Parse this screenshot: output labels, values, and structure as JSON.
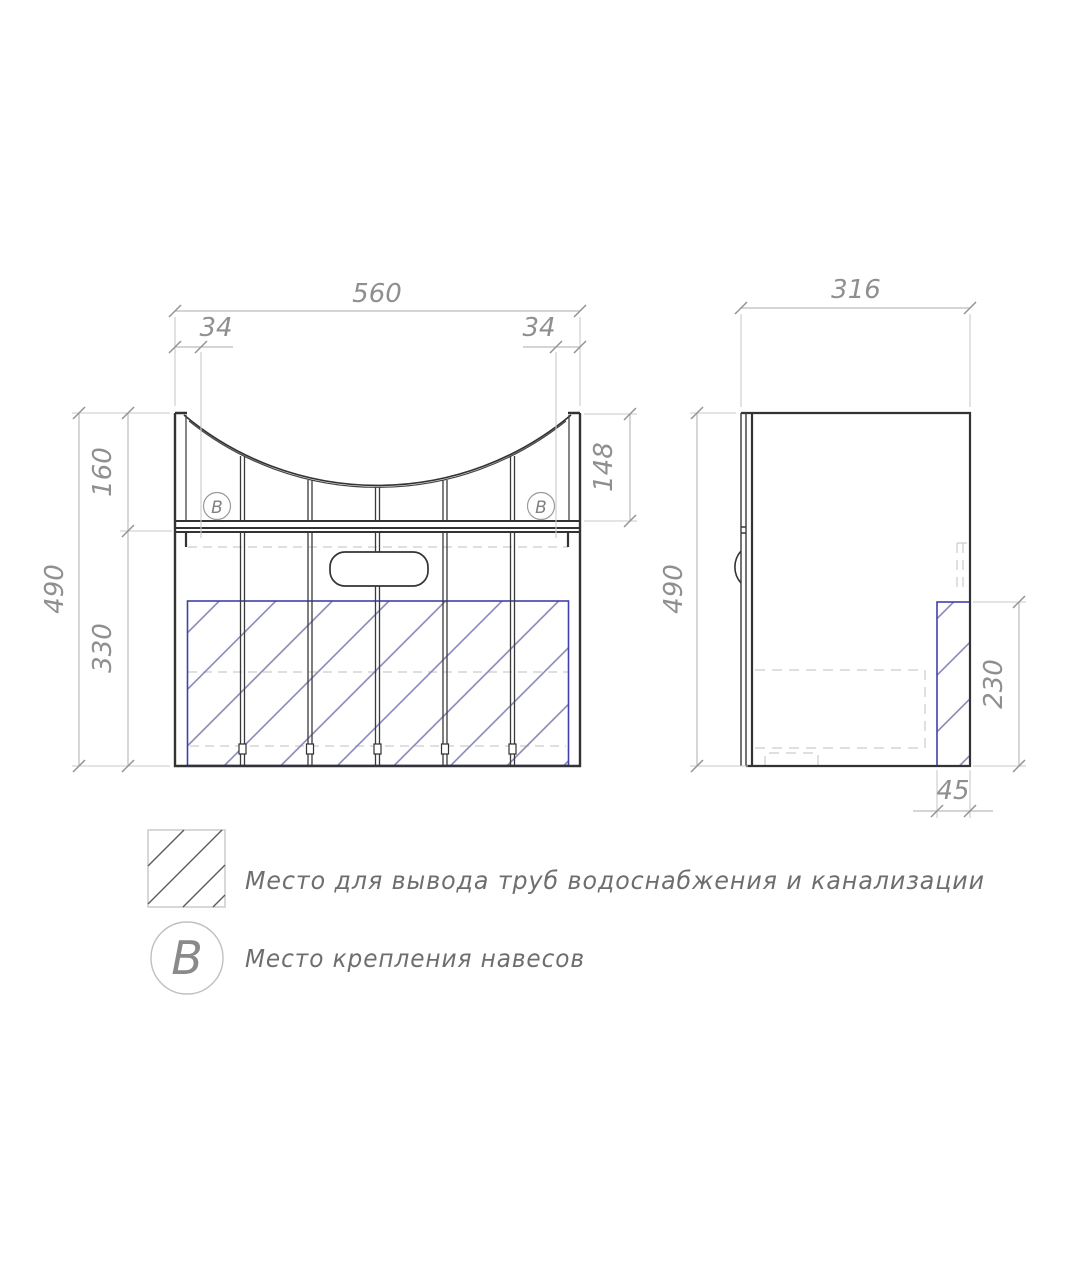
{
  "front": {
    "width": "560",
    "offset_left": "34",
    "offset_right": "34",
    "height_total": "490",
    "height_upper": "160",
    "height_lower": "330",
    "height_basin_side": "148",
    "marker": "В"
  },
  "side": {
    "depth": "316",
    "height_total": "490",
    "pipe_zone_height": "230",
    "pipe_zone_width": "45"
  },
  "legend": {
    "pipe_zone_text": "Место для вывода труб водоснабжения и канализации",
    "marker_symbol": "В",
    "marker_text": "Место крепления навесов"
  },
  "colors": {
    "object_line": "#333333",
    "dim_line": "#bcbcbc",
    "dim_text": "#8f8f8f",
    "hatch_border": "#4040ad",
    "hatch_line": "#8080b3",
    "hidden_line": "#cccccc"
  }
}
